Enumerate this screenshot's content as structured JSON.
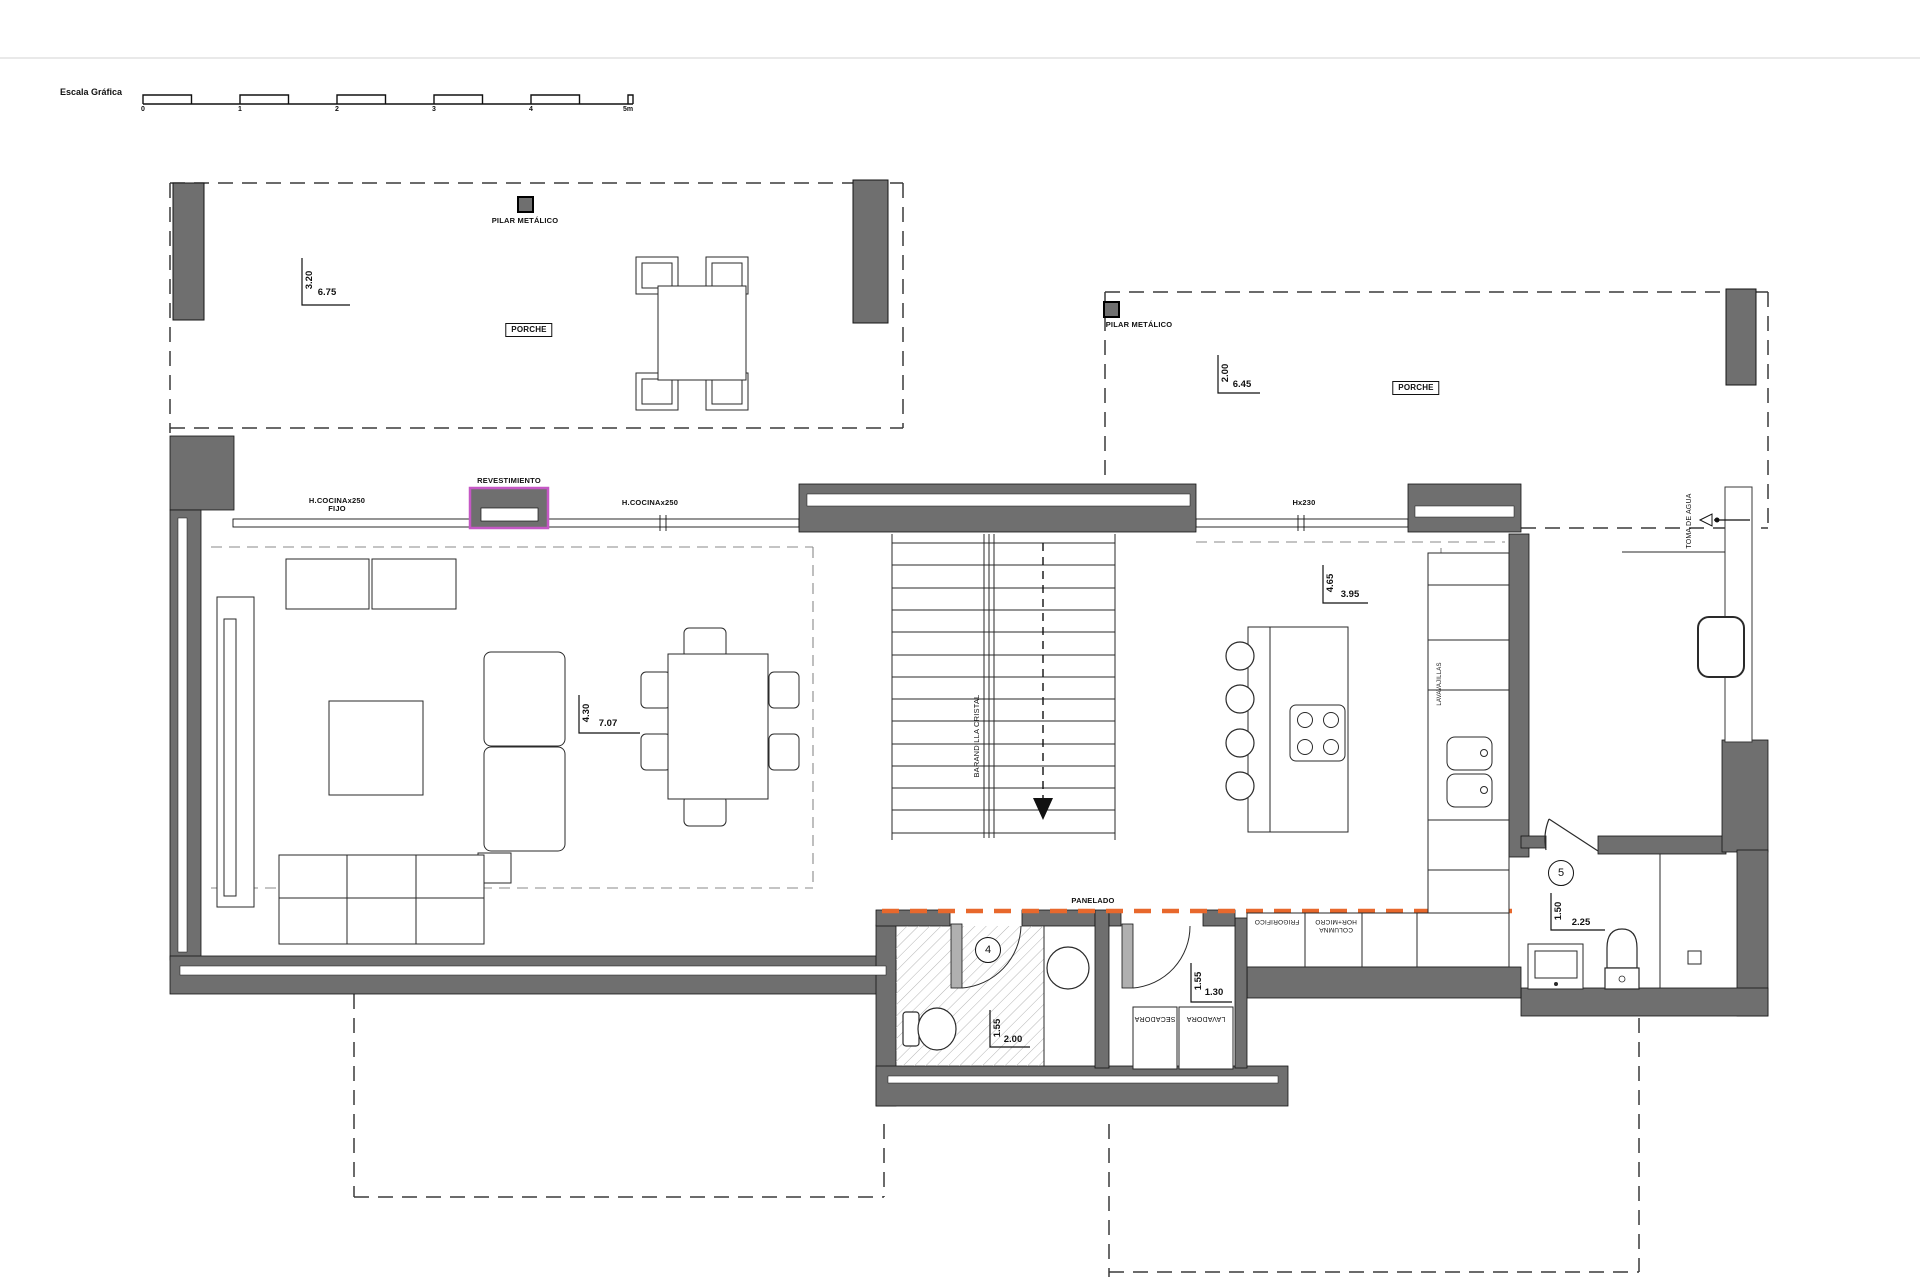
{
  "scale_bar": {
    "title": "Escala Gráfica",
    "ticks": [
      "0",
      "1",
      "2",
      "3",
      "4",
      "5m"
    ]
  },
  "porch_left": {
    "pillar": "PILAR METÁLICO",
    "dim_v": "3.20",
    "dim_h": "6.75",
    "room": "PORCHE"
  },
  "porch_right": {
    "pillar": "PILAR METÁLICO",
    "dim_v": "2.00",
    "dim_h": "6.45",
    "room": "PORCHE"
  },
  "facade": {
    "cladding": "REVESTIMIENTO",
    "window_a1": "H.COCINAx250",
    "window_a2": "FIJO",
    "window_b": "H.COCINAx250",
    "window_c": "Hx230"
  },
  "living_room": {
    "dim_v": "4.30",
    "dim_h": "7.07"
  },
  "stairs": {
    "railing": "BARANDILLA CRISTAL"
  },
  "kitchen": {
    "dim_v": "4.65",
    "dim_h": "3.95",
    "dishwasher": "LAVAVAJILLAS",
    "fridge": "FRIGORIFICO",
    "column1": "COLUMNA",
    "column2": "HOR+MICRO",
    "paneling": "PANELADO"
  },
  "bathroom4": {
    "number": "4",
    "dim_v": "1.55",
    "dim_h": "2.00"
  },
  "laundry": {
    "dim_v": "1.55",
    "dim_h": "1.30",
    "dryer": "SECADORA",
    "washer": "LAVADORA"
  },
  "wc5": {
    "number": "5",
    "dim_v": "1.50",
    "dim_h": "2.25"
  },
  "services": {
    "water_intake": "TOMA DE AGUA"
  },
  "colors": {
    "wall": "#6f6f6f",
    "paneling": "#e8682c",
    "cladding": "#c558c5"
  }
}
